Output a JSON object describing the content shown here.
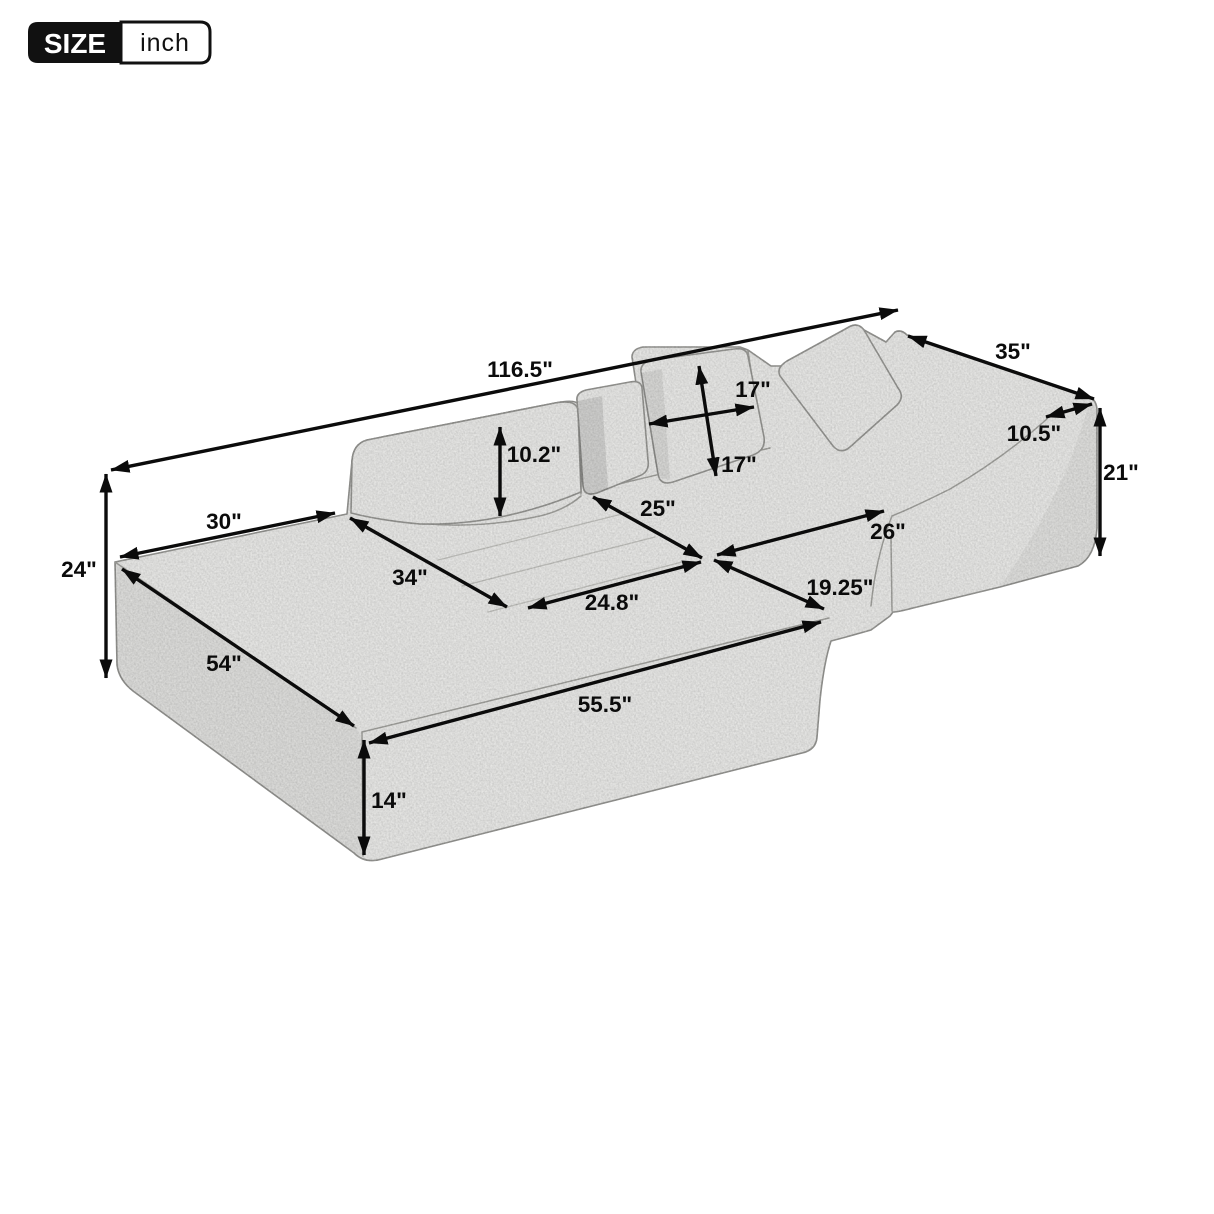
{
  "badge": {
    "size_label": "SIZE",
    "unit_label": "inch"
  },
  "dimensions": {
    "total_length": "116.5\"",
    "right_section_width": "35\"",
    "arm_depth": "10.5\"",
    "right_height": "21\"",
    "pillow_width": "17\"",
    "pillow_height": "17\"",
    "backrest_height": "10.2\"",
    "left_seat_width": "25\"",
    "right_seat_width": "26\"",
    "chaise_back_width": "30\"",
    "left_height": "24\"",
    "chaise_length": "34\"",
    "left_seat_depth": "24.8\"",
    "right_seat_depth": "19.25\"",
    "chaise_side_depth": "54\"",
    "front_length": "55.5\"",
    "base_height": "14\""
  },
  "colors": {
    "dimension_line": "#0b0b0b",
    "fabric": "#f0f0ee",
    "fabric_outline": "#9b9b98",
    "badge_background": "#111111"
  }
}
